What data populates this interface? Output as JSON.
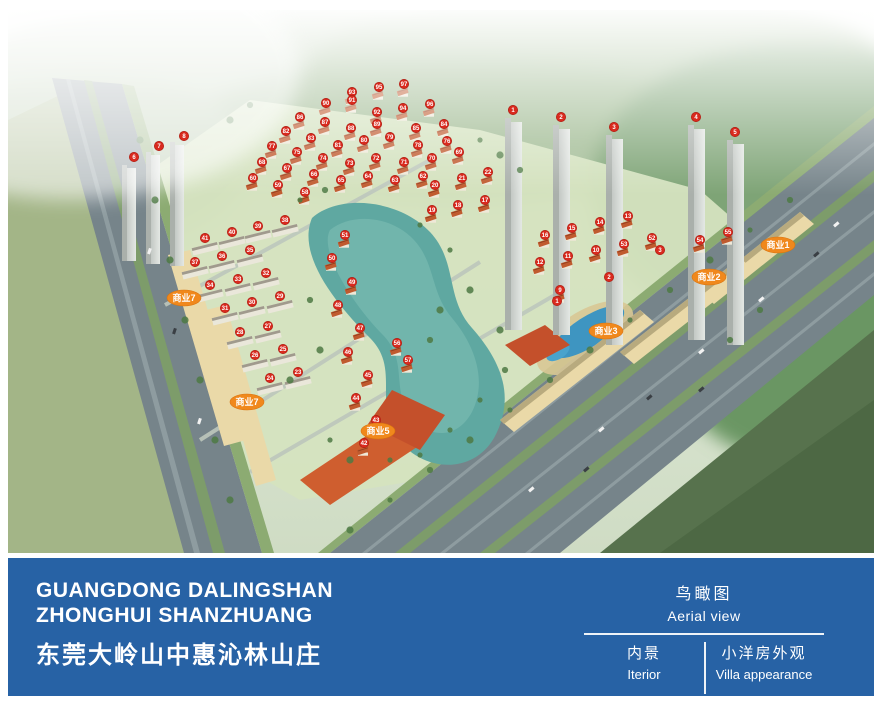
{
  "footer": {
    "bg_color": "#2762a5",
    "title_en_line1": "GUANGDONG DALINGSHAN",
    "title_en_line2": "ZHONGHUI SHANZHUANG",
    "title_cn": "东莞大岭山中惠沁林山庄",
    "caption": {
      "primary_cn": "鸟瞰图",
      "primary_en": "Aerial view",
      "left_cn": "内景",
      "left_en": "Iterior",
      "right_cn": "小洋房外观",
      "right_en": "Villa appearance"
    }
  },
  "aerial_view": {
    "marker_color": "#d92a1e",
    "label_color": "#f0881c",
    "commercial_labels": [
      {
        "text": "商业1",
        "x": 778,
        "y": 245
      },
      {
        "text": "商业2",
        "x": 709,
        "y": 277
      },
      {
        "text": "商业3",
        "x": 606,
        "y": 331
      },
      {
        "text": "商业5",
        "x": 378,
        "y": 431
      },
      {
        "text": "商业7",
        "x": 184,
        "y": 298
      },
      {
        "text": "商业7",
        "x": 247,
        "y": 402
      }
    ],
    "plot_markers": [
      {
        "n": "93",
        "x": 352,
        "y": 92,
        "b": "v"
      },
      {
        "n": "95",
        "x": 379,
        "y": 87,
        "b": "v"
      },
      {
        "n": "97",
        "x": 404,
        "y": 84,
        "b": "v"
      },
      {
        "n": "90",
        "x": 326,
        "y": 103,
        "b": "v"
      },
      {
        "n": "91",
        "x": 352,
        "y": 100,
        "b": "v"
      },
      {
        "n": "92",
        "x": 377,
        "y": 112,
        "b": "v"
      },
      {
        "n": "94",
        "x": 403,
        "y": 108,
        "b": "v"
      },
      {
        "n": "96",
        "x": 430,
        "y": 104,
        "b": "v"
      },
      {
        "n": "86",
        "x": 300,
        "y": 117,
        "b": "v"
      },
      {
        "n": "87",
        "x": 325,
        "y": 122,
        "b": "v"
      },
      {
        "n": "88",
        "x": 351,
        "y": 128,
        "b": "v"
      },
      {
        "n": "89",
        "x": 377,
        "y": 124,
        "b": "v"
      },
      {
        "n": "85",
        "x": 416,
        "y": 128,
        "b": "v"
      },
      {
        "n": "84",
        "x": 444,
        "y": 124,
        "b": "v"
      },
      {
        "n": "82",
        "x": 286,
        "y": 131,
        "b": "v"
      },
      {
        "n": "83",
        "x": 311,
        "y": 138,
        "b": "v"
      },
      {
        "n": "81",
        "x": 338,
        "y": 145,
        "b": "v"
      },
      {
        "n": "80",
        "x": 364,
        "y": 140,
        "b": "v"
      },
      {
        "n": "79",
        "x": 390,
        "y": 137,
        "b": "v"
      },
      {
        "n": "78",
        "x": 418,
        "y": 145,
        "b": "v"
      },
      {
        "n": "76",
        "x": 447,
        "y": 141,
        "b": "v"
      },
      {
        "n": "77",
        "x": 272,
        "y": 146,
        "b": "v"
      },
      {
        "n": "75",
        "x": 297,
        "y": 152,
        "b": "v"
      },
      {
        "n": "74",
        "x": 323,
        "y": 158,
        "b": "v"
      },
      {
        "n": "73",
        "x": 350,
        "y": 163,
        "b": "v"
      },
      {
        "n": "72",
        "x": 376,
        "y": 158,
        "b": "v"
      },
      {
        "n": "71",
        "x": 404,
        "y": 162,
        "b": "v"
      },
      {
        "n": "70",
        "x": 432,
        "y": 158,
        "b": "v"
      },
      {
        "n": "69",
        "x": 459,
        "y": 152,
        "b": "v"
      },
      {
        "n": "68",
        "x": 262,
        "y": 162,
        "b": "v"
      },
      {
        "n": "67",
        "x": 287,
        "y": 168,
        "b": "v"
      },
      {
        "n": "66",
        "x": 314,
        "y": 174,
        "b": "v"
      },
      {
        "n": "65",
        "x": 341,
        "y": 180,
        "b": "v"
      },
      {
        "n": "64",
        "x": 368,
        "y": 176,
        "b": "v"
      },
      {
        "n": "63",
        "x": 395,
        "y": 180,
        "b": "v"
      },
      {
        "n": "62",
        "x": 423,
        "y": 176,
        "b": "v"
      },
      {
        "n": "60",
        "x": 253,
        "y": 178,
        "b": "v"
      },
      {
        "n": "59",
        "x": 278,
        "y": 185,
        "b": "v"
      },
      {
        "n": "58",
        "x": 305,
        "y": 192,
        "b": "v"
      },
      {
        "n": "20",
        "x": 435,
        "y": 185,
        "b": "v"
      },
      {
        "n": "21",
        "x": 462,
        "y": 178,
        "b": "v"
      },
      {
        "n": "22",
        "x": 488,
        "y": 172,
        "b": "v"
      },
      {
        "n": "19",
        "x": 432,
        "y": 210,
        "b": "v"
      },
      {
        "n": "18",
        "x": 458,
        "y": 205,
        "b": "v"
      },
      {
        "n": "17",
        "x": 485,
        "y": 200,
        "b": "v"
      },
      {
        "n": "16",
        "x": 545,
        "y": 235,
        "b": "v"
      },
      {
        "n": "15",
        "x": 572,
        "y": 228,
        "b": "v"
      },
      {
        "n": "14",
        "x": 600,
        "y": 222,
        "b": "v"
      },
      {
        "n": "13",
        "x": 628,
        "y": 216,
        "b": "v"
      },
      {
        "n": "12",
        "x": 540,
        "y": 262,
        "b": "v"
      },
      {
        "n": "11",
        "x": 568,
        "y": 256,
        "b": "v"
      },
      {
        "n": "10",
        "x": 596,
        "y": 250,
        "b": "v"
      },
      {
        "n": "9",
        "x": 560,
        "y": 290,
        "b": "v"
      },
      {
        "n": "53",
        "x": 624,
        "y": 244,
        "b": "v"
      },
      {
        "n": "52",
        "x": 652,
        "y": 238,
        "b": "v"
      },
      {
        "n": "54",
        "x": 700,
        "y": 240,
        "b": "v"
      },
      {
        "n": "55",
        "x": 728,
        "y": 232,
        "b": "v"
      },
      {
        "n": "51",
        "x": 345,
        "y": 235,
        "b": "v"
      },
      {
        "n": "50",
        "x": 332,
        "y": 258,
        "b": "v"
      },
      {
        "n": "49",
        "x": 352,
        "y": 282,
        "b": "v"
      },
      {
        "n": "48",
        "x": 338,
        "y": 305,
        "b": "v"
      },
      {
        "n": "47",
        "x": 360,
        "y": 328,
        "b": "v"
      },
      {
        "n": "46",
        "x": 348,
        "y": 352,
        "b": "v"
      },
      {
        "n": "45",
        "x": 368,
        "y": 375,
        "b": "v"
      },
      {
        "n": "44",
        "x": 356,
        "y": 398,
        "b": "v"
      },
      {
        "n": "43",
        "x": 376,
        "y": 420,
        "b": "v"
      },
      {
        "n": "42",
        "x": 364,
        "y": 443,
        "b": "v"
      },
      {
        "n": "41",
        "x": 205,
        "y": 238,
        "b": "a"
      },
      {
        "n": "40",
        "x": 232,
        "y": 232,
        "b": "a"
      },
      {
        "n": "39",
        "x": 258,
        "y": 226,
        "b": "a"
      },
      {
        "n": "38",
        "x": 285,
        "y": 220,
        "b": "a"
      },
      {
        "n": "37",
        "x": 195,
        "y": 262,
        "b": "a"
      },
      {
        "n": "36",
        "x": 222,
        "y": 256,
        "b": "a"
      },
      {
        "n": "35",
        "x": 250,
        "y": 250,
        "b": "a"
      },
      {
        "n": "34",
        "x": 210,
        "y": 285,
        "b": "a"
      },
      {
        "n": "33",
        "x": 238,
        "y": 279,
        "b": "a"
      },
      {
        "n": "32",
        "x": 266,
        "y": 273,
        "b": "a"
      },
      {
        "n": "31",
        "x": 225,
        "y": 308,
        "b": "a"
      },
      {
        "n": "30",
        "x": 252,
        "y": 302,
        "b": "a"
      },
      {
        "n": "29",
        "x": 280,
        "y": 296,
        "b": "a"
      },
      {
        "n": "28",
        "x": 240,
        "y": 332,
        "b": "a"
      },
      {
        "n": "27",
        "x": 268,
        "y": 326,
        "b": "a"
      },
      {
        "n": "26",
        "x": 255,
        "y": 355,
        "b": "a"
      },
      {
        "n": "25",
        "x": 283,
        "y": 349,
        "b": "a"
      },
      {
        "n": "24",
        "x": 270,
        "y": 378,
        "b": "a"
      },
      {
        "n": "23",
        "x": 298,
        "y": 372,
        "b": "a"
      },
      {
        "n": "1",
        "x": 557,
        "y": 301
      },
      {
        "n": "2",
        "x": 609,
        "y": 277
      },
      {
        "n": "3",
        "x": 660,
        "y": 250
      },
      {
        "n": "56",
        "x": 397,
        "y": 343,
        "b": "v"
      },
      {
        "n": "57",
        "x": 408,
        "y": 360,
        "b": "v"
      },
      {
        "n": "1",
        "x": 513,
        "y": 110
      },
      {
        "n": "2",
        "x": 561,
        "y": 117
      },
      {
        "n": "3",
        "x": 614,
        "y": 127
      },
      {
        "n": "4",
        "x": 696,
        "y": 117
      },
      {
        "n": "5",
        "x": 735,
        "y": 132
      },
      {
        "n": "6",
        "x": 134,
        "y": 157
      },
      {
        "n": "7",
        "x": 159,
        "y": 146
      },
      {
        "n": "8",
        "x": 184,
        "y": 136
      }
    ]
  }
}
